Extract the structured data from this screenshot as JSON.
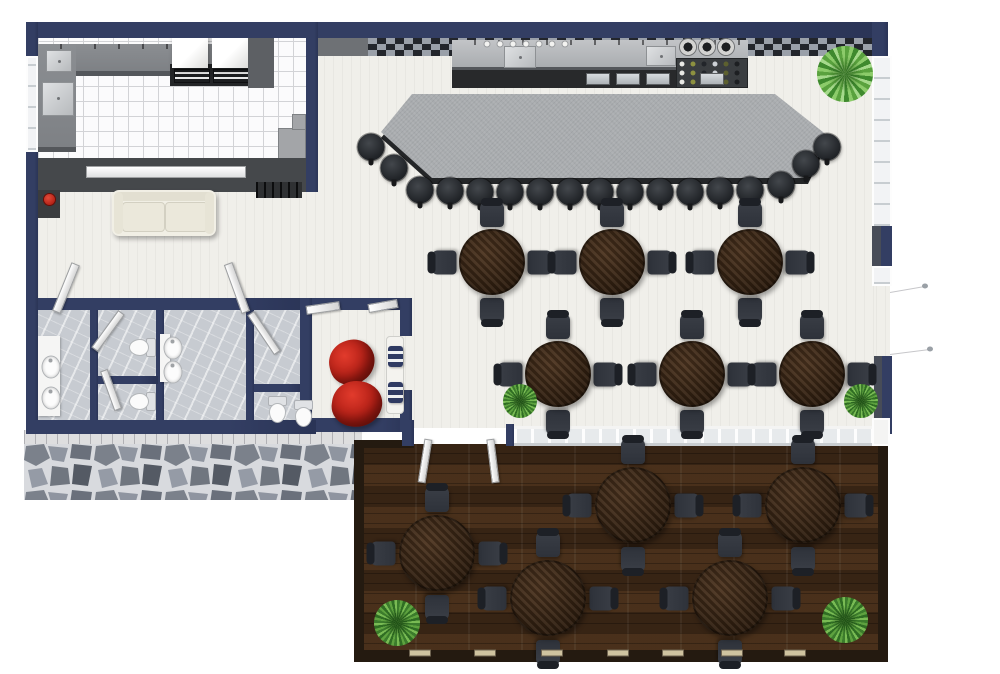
{
  "scene": {
    "width": 1000,
    "height": 674
  },
  "palette": {
    "wall": "#333e63",
    "wallInner": "#474c57",
    "floor": "#f0efea",
    "kitchenTile": "#fbfbfc",
    "tileLine": "#d2d3d6",
    "counter": "#7e8185",
    "counterEdge": "#54575b",
    "kitchenWallDark": "#45484b",
    "barTop": "#a9acaf",
    "barBase": "#242628",
    "stool": "#2b2e31",
    "backsplash": "#9aa0a9",
    "backsplashDark": "#23262c",
    "wood": "#3c2915",
    "chair": "#2e323a",
    "patio": "#402b19",
    "fence": "#241a10",
    "fenceCap": "#cfc3a0",
    "marble": "#c7cbd1",
    "stone": "#d9dade",
    "sill": "#dededf",
    "red": "#c3271d",
    "sofa": "#f1efe5",
    "glass": "#e7eaec",
    "plantDark": "#3c7c2c",
    "plantLight": "#79bb54"
  },
  "furniture": {
    "dining_tables": [
      {
        "x": 492,
        "y": 262
      },
      {
        "x": 612,
        "y": 262
      },
      {
        "x": 750,
        "y": 262
      },
      {
        "x": 558,
        "y": 374
      },
      {
        "x": 692,
        "y": 374
      },
      {
        "x": 812,
        "y": 374
      }
    ],
    "patio_tables": [
      {
        "x": 437,
        "y": 553
      },
      {
        "x": 548,
        "y": 598
      },
      {
        "x": 633,
        "y": 505
      },
      {
        "x": 730,
        "y": 598
      },
      {
        "x": 803,
        "y": 505
      }
    ],
    "bar_stools": [
      {
        "x": 371,
        "y": 147
      },
      {
        "x": 394,
        "y": 168
      },
      {
        "x": 420,
        "y": 190
      },
      {
        "x": 450,
        "y": 191
      },
      {
        "x": 480,
        "y": 192
      },
      {
        "x": 510,
        "y": 192
      },
      {
        "x": 540,
        "y": 192
      },
      {
        "x": 570,
        "y": 192
      },
      {
        "x": 600,
        "y": 192
      },
      {
        "x": 630,
        "y": 192
      },
      {
        "x": 660,
        "y": 192
      },
      {
        "x": 690,
        "y": 192
      },
      {
        "x": 720,
        "y": 191
      },
      {
        "x": 750,
        "y": 190
      },
      {
        "x": 781,
        "y": 185
      },
      {
        "x": 806,
        "y": 164
      },
      {
        "x": 827,
        "y": 147
      }
    ],
    "bean_bags": [
      {
        "x": 352,
        "y": 362,
        "w": 46,
        "h": 44,
        "rot": -15
      },
      {
        "x": 357,
        "y": 404,
        "w": 50,
        "h": 46,
        "rot": 8
      }
    ],
    "plants": [
      {
        "x": 845,
        "y": 74,
        "d": 56,
        "type": "palm"
      },
      {
        "x": 520,
        "y": 401,
        "d": 34,
        "type": "bush"
      },
      {
        "x": 861,
        "y": 401,
        "d": 34,
        "type": "bush"
      },
      {
        "x": 397,
        "y": 623,
        "d": 46,
        "type": "bush"
      },
      {
        "x": 845,
        "y": 620,
        "d": 46,
        "type": "bush"
      }
    ],
    "restroom_sinks": [
      {
        "x": 51,
        "y": 367
      },
      {
        "x": 51,
        "y": 398
      },
      {
        "x": 173,
        "y": 348
      },
      {
        "x": 173,
        "y": 372
      }
    ],
    "toilets": [
      {
        "x": 143,
        "y": 347,
        "rot": 90
      },
      {
        "x": 143,
        "y": 401,
        "rot": 90
      },
      {
        "x": 277,
        "y": 409,
        "rot": 0
      },
      {
        "x": 303,
        "y": 413,
        "rot": 0
      }
    ],
    "doors": [
      {
        "x": 66,
        "y": 288,
        "w": 9,
        "h": 52,
        "rot": 22
      },
      {
        "x": 237,
        "y": 288,
        "w": 9,
        "h": 52,
        "rot": -20
      },
      {
        "x": 108,
        "y": 331,
        "w": 8,
        "h": 46,
        "rot": 36
      },
      {
        "x": 264,
        "y": 333,
        "w": 8,
        "h": 48,
        "rot": -34
      },
      {
        "x": 111,
        "y": 390,
        "w": 8,
        "h": 42,
        "rot": -20
      },
      {
        "x": 323,
        "y": 308,
        "w": 34,
        "h": 9,
        "rot": -8
      },
      {
        "x": 383,
        "y": 306,
        "w": 30,
        "h": 9,
        "rot": -10
      },
      {
        "x": 425,
        "y": 461,
        "w": 8,
        "h": 44,
        "rot": 9
      },
      {
        "x": 493,
        "y": 461,
        "w": 8,
        "h": 44,
        "rot": -7
      }
    ],
    "fence_caps": {
      "y": 653,
      "xs": [
        420,
        485,
        552,
        618,
        673,
        732,
        795
      ]
    },
    "glasses": {
      "y": 44,
      "x0": 487,
      "dx": 13,
      "count": 7,
      "d": 5,
      "color": "#f3f3f1"
    },
    "burners": {
      "y": 47,
      "xs": [
        688,
        707,
        726
      ]
    },
    "bottles": {
      "x0": 682,
      "y0": 64,
      "dx": 11,
      "dy": 9,
      "cols": 6,
      "rows": 3,
      "d": 5,
      "colors": [
        "#e9e9e5",
        "#8d9140",
        "#22252a",
        "#cdd1d6",
        "#5d602f",
        "#1d1f22"
      ]
    },
    "cooler_doors": {
      "y": 73,
      "xs": [
        586,
        616,
        646,
        700
      ],
      "w": 24,
      "h": 12
    },
    "door_swings": [
      {
        "x1": 890,
        "y1": 292,
        "x2": 925,
        "y2": 286
      },
      {
        "x1": 890,
        "y1": 354,
        "x2": 930,
        "y2": 349
      }
    ]
  }
}
